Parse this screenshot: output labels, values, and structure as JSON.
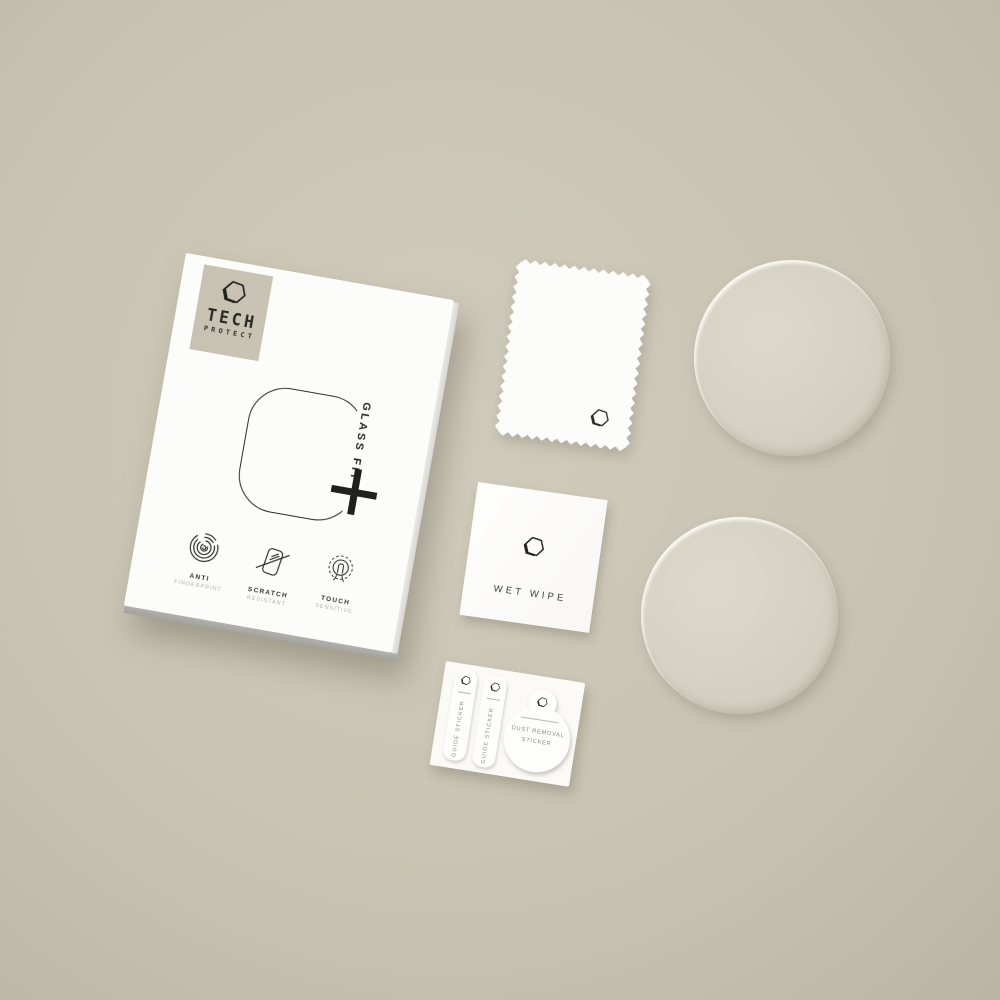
{
  "scene": {
    "description": "Flat-lay product photo of a Tech-Protect GlassFit smartwatch tempered glass kit",
    "background_color": "#c8c2b1"
  },
  "brand": {
    "name": "TECH",
    "subname": "PROTECT",
    "logo_icon": "hexagon-nut-logo"
  },
  "box": {
    "product_line_label": "GLASS FIT",
    "plus_symbol": "+",
    "features": [
      {
        "icon": "fingerprint-icon",
        "title": "ANTI",
        "subtitle": "FINGERPRINT"
      },
      {
        "icon": "scratch-icon",
        "title": "SCRATCH",
        "subtitle": "RESISTANT"
      },
      {
        "icon": "touch-icon",
        "title": "TOUCH",
        "subtitle": "SENSITIVE"
      }
    ]
  },
  "accessories": {
    "cloth": {
      "name": "microfiber cloth"
    },
    "wet_wipe": {
      "label": "WET WIPE"
    },
    "sticker_sheet": {
      "guide_stickers": [
        {
          "label": "GUIDE STICKER"
        },
        {
          "label": "GUIDE STICKER"
        }
      ],
      "dust_removal": {
        "label_line1": "DUST REMOVAL",
        "label_line2": "STICKER"
      }
    },
    "glass_protectors": {
      "count": 2
    }
  },
  "colors": {
    "background": "#c8c2b1",
    "card_white": "#fcfcfb",
    "glass_disc": "#d5d1c2",
    "ink": "#23231e",
    "muted_text": "#8f8a7e"
  }
}
